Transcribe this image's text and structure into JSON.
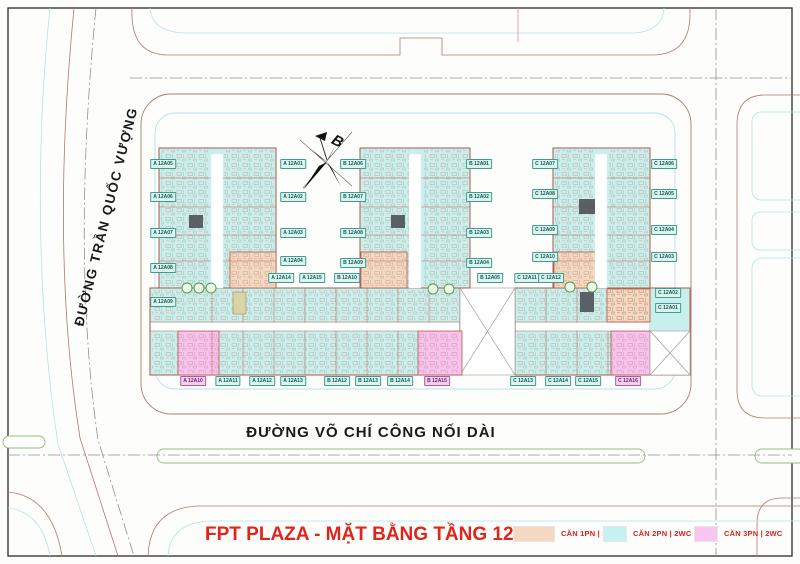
{
  "map": {
    "title": "FPT PLAZA - MẶT BẰNG TẦNG 12A",
    "streets": {
      "left": "ĐƯỜNG TRẦN QUỐC VƯỢNG",
      "bottom": "ĐƯỜNG VÕ CHÍ CÔNG NỐI DÀI"
    },
    "compass_label": "B",
    "legend": [
      {
        "label": "CĂN 1PN | 1WC",
        "color": "#f2d9c0",
        "swatch_width": 40
      },
      {
        "label": "CĂN 2PN | 2WC",
        "color": "#c5f2f1",
        "swatch_width": 22
      },
      {
        "label": "CĂN 3PN | 2WC",
        "color": "#f9c4ef",
        "swatch_width": 22
      }
    ],
    "colors": {
      "title_red": "#e1251b",
      "legend_text_red": "#d3231c",
      "unit_2pn": "#c9efec",
      "unit_1pn": "#f2d9c0",
      "unit_3pn": "#f7c3ee",
      "plan_outline": "#b0574a",
      "road_edge_brown": "#ad7a6e",
      "road_edge_cyan": "#b5e2e4",
      "median_green": "#8fbf7f",
      "centerline_gray": "#909090"
    },
    "unit_tags": [
      {
        "label": "A 12A05",
        "x": 163,
        "y": 164,
        "type": "2pn"
      },
      {
        "label": "A 12A06",
        "x": 163,
        "y": 197,
        "type": "2pn"
      },
      {
        "label": "A 12A07",
        "x": 163,
        "y": 233,
        "type": "2pn"
      },
      {
        "label": "A 12A08",
        "x": 163,
        "y": 268,
        "type": "2pn"
      },
      {
        "label": "A 12A09",
        "x": 163,
        "y": 302,
        "type": "2pn"
      },
      {
        "label": "A 12A01",
        "x": 293,
        "y": 164,
        "type": "2pn"
      },
      {
        "label": "A 12A02",
        "x": 293,
        "y": 197,
        "type": "2pn"
      },
      {
        "label": "A 12A03",
        "x": 293,
        "y": 233,
        "type": "2pn"
      },
      {
        "label": "A 12A04",
        "x": 293,
        "y": 261,
        "type": "2pn"
      },
      {
        "label": "A 12A14",
        "x": 281,
        "y": 278,
        "type": "2pn"
      },
      {
        "label": "A 12A15",
        "x": 312,
        "y": 278,
        "type": "2pn"
      },
      {
        "label": "B 12A10",
        "x": 347,
        "y": 278,
        "type": "2pn"
      },
      {
        "label": "B 12A06",
        "x": 353,
        "y": 164,
        "type": "2pn"
      },
      {
        "label": "B 12A07",
        "x": 353,
        "y": 197,
        "type": "2pn"
      },
      {
        "label": "B 12A08",
        "x": 353,
        "y": 233,
        "type": "2pn"
      },
      {
        "label": "B 12A09",
        "x": 353,
        "y": 263,
        "type": "2pn"
      },
      {
        "label": "B 12A01",
        "x": 479,
        "y": 164,
        "type": "2pn"
      },
      {
        "label": "B 12A02",
        "x": 479,
        "y": 197,
        "type": "2pn"
      },
      {
        "label": "B 12A03",
        "x": 479,
        "y": 233,
        "type": "2pn"
      },
      {
        "label": "B 12A04",
        "x": 479,
        "y": 263,
        "type": "2pn"
      },
      {
        "label": "B 12A05",
        "x": 490,
        "y": 278,
        "type": "2pn"
      },
      {
        "label": "C 12A11",
        "x": 527,
        "y": 278,
        "type": "2pn"
      },
      {
        "label": "C 12A12",
        "x": 551,
        "y": 278,
        "type": "2pn"
      },
      {
        "label": "C 12A07",
        "x": 545,
        "y": 164,
        "type": "2pn"
      },
      {
        "label": "C 12A08",
        "x": 545,
        "y": 194,
        "type": "2pn"
      },
      {
        "label": "C 12A09",
        "x": 545,
        "y": 230,
        "type": "2pn"
      },
      {
        "label": "C 12A10",
        "x": 545,
        "y": 257,
        "type": "2pn"
      },
      {
        "label": "C 12A06",
        "x": 664,
        "y": 164,
        "type": "2pn"
      },
      {
        "label": "C 12A05",
        "x": 664,
        "y": 194,
        "type": "2pn"
      },
      {
        "label": "C 12A04",
        "x": 664,
        "y": 230,
        "type": "2pn"
      },
      {
        "label": "C 12A03",
        "x": 664,
        "y": 257,
        "type": "2pn"
      },
      {
        "label": "C 12A02",
        "x": 668,
        "y": 293,
        "type": "2pn"
      },
      {
        "label": "C 12A01",
        "x": 668,
        "y": 308,
        "type": "2pn"
      },
      {
        "label": "A 12A10",
        "x": 193,
        "y": 381,
        "type": "3pn"
      },
      {
        "label": "A 12A11",
        "x": 228,
        "y": 381,
        "type": "2pn"
      },
      {
        "label": "A 12A12",
        "x": 262,
        "y": 381,
        "type": "2pn"
      },
      {
        "label": "A 12A13",
        "x": 293,
        "y": 381,
        "type": "2pn"
      },
      {
        "label": "B 12A12",
        "x": 337,
        "y": 381,
        "type": "2pn"
      },
      {
        "label": "B 12A13",
        "x": 368,
        "y": 381,
        "type": "2pn"
      },
      {
        "label": "B 12A14",
        "x": 400,
        "y": 381,
        "type": "2pn"
      },
      {
        "label": "B 12A15",
        "x": 437,
        "y": 381,
        "type": "3pn"
      },
      {
        "label": "C 12A13",
        "x": 523,
        "y": 381,
        "type": "2pn"
      },
      {
        "label": "C 12A14",
        "x": 558,
        "y": 381,
        "type": "2pn"
      },
      {
        "label": "C 12A15",
        "x": 588,
        "y": 381,
        "type": "2pn"
      },
      {
        "label": "C 12A16",
        "x": 628,
        "y": 381,
        "type": "3pn"
      }
    ]
  }
}
